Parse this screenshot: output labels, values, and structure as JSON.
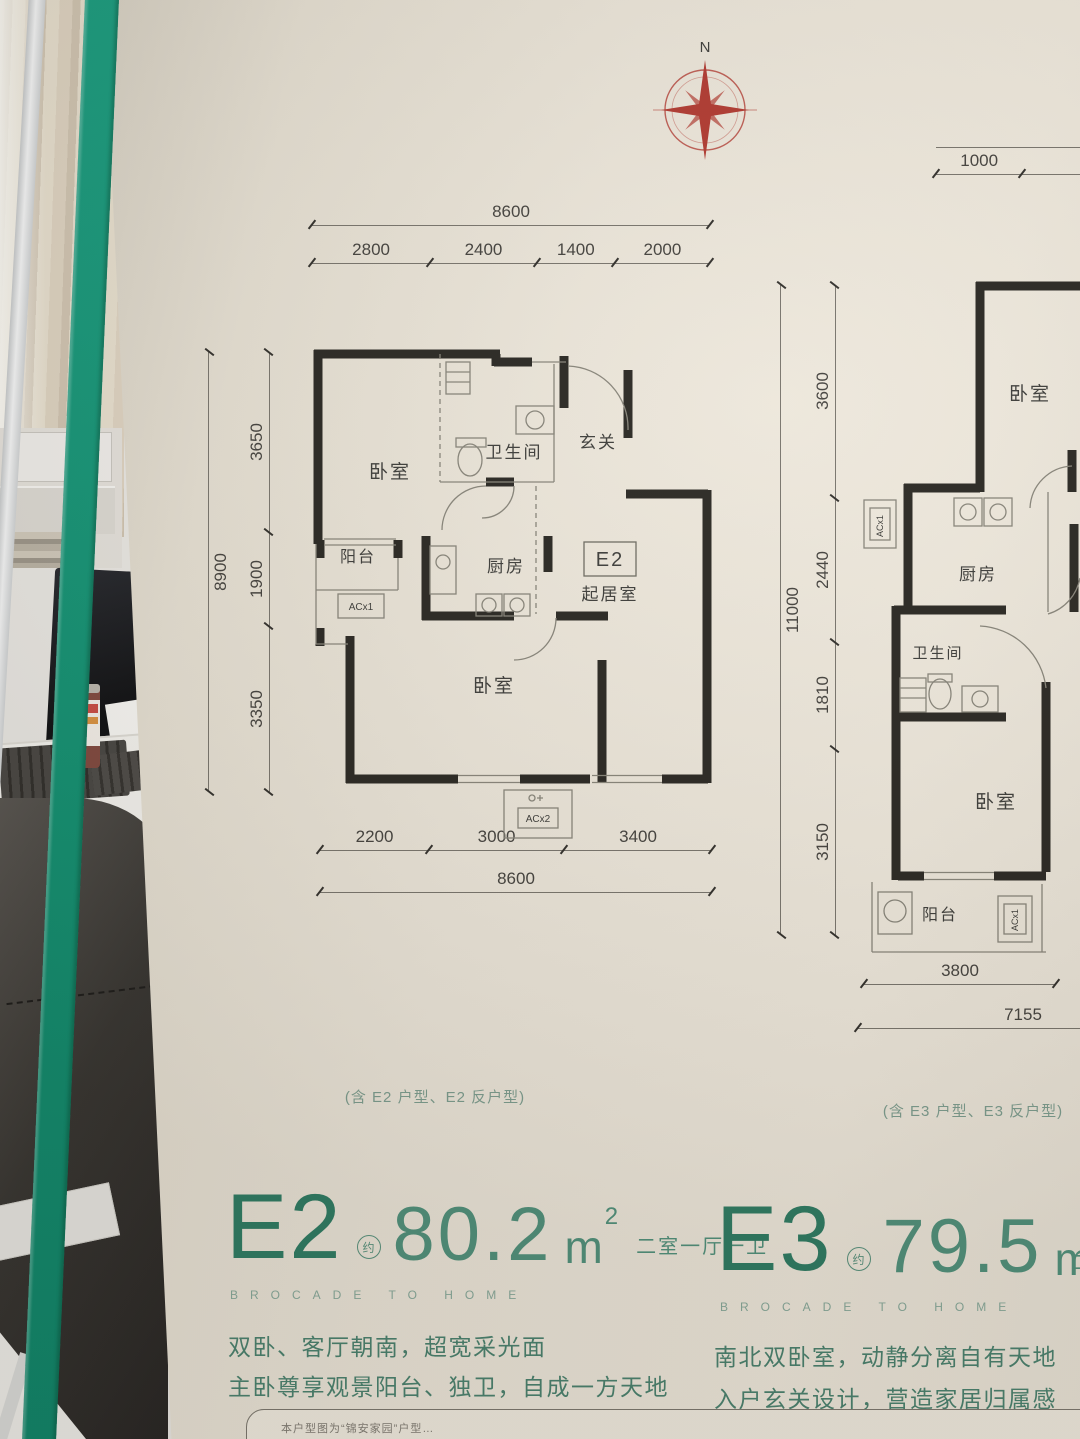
{
  "compass": {
    "north_label": "N"
  },
  "e2": {
    "dims": {
      "top_total": "8600",
      "top_segments": [
        "2800",
        "2400",
        "1400",
        "2000"
      ],
      "left_total": "8900",
      "left_segments": [
        "3650",
        "1900",
        "3350"
      ],
      "bottom_segments": [
        "2200",
        "3000",
        "3400"
      ],
      "bottom_total": "8600"
    },
    "rooms": {
      "bedroom_north": "卧室",
      "bathroom": "卫生间",
      "entry": "玄关",
      "balcony": "阳台",
      "kitchen": "厨房",
      "unit_tag": "E2",
      "living": "起居室",
      "bedroom_south": "卧室",
      "ac_balcony": "ACx1",
      "ac_south": "ACx2"
    },
    "note": "(含 E2 户型、E2 反户型)",
    "title": {
      "code": "E2",
      "approx": "约",
      "area": "80.2",
      "unit": "m",
      "unit_sup": "2",
      "layout": "二室一厅一卫",
      "slogan": "BROCADE TO HOME"
    },
    "desc_line1": "双卧、客厅朝南，超宽采光面",
    "desc_line2": "主卧尊享观景阳台、独卫，自成一方天地"
  },
  "e3": {
    "dims": {
      "top_segments": [
        "1000",
        "2800"
      ],
      "left_total": "11000",
      "left_segments": [
        "3600",
        "2440",
        "1810",
        "3150"
      ],
      "bottom_first": "3800",
      "bottom_total": "7155"
    },
    "rooms": {
      "bedroom_north": "卧室",
      "kitchen": "厨房",
      "bathroom": "卫生间",
      "bedroom_south": "卧室",
      "balcony": "阳台",
      "ac_left": "ACx1",
      "ac_balcony": "ACx1"
    },
    "note": "(含 E3 户型、E3 反户型)",
    "title": {
      "code": "E3",
      "approx": "约",
      "area": "79.5",
      "unit": "m",
      "unit_sup": "2",
      "layout_partial": "二室",
      "slogan": "BROCADE TO HOME"
    },
    "desc_line1": "南北双卧室，动静分离自有天地",
    "desc_line2": "入户玄关设计，营造家居归属感"
  },
  "footnote": "本户型图为“锦安家园”户型…"
}
